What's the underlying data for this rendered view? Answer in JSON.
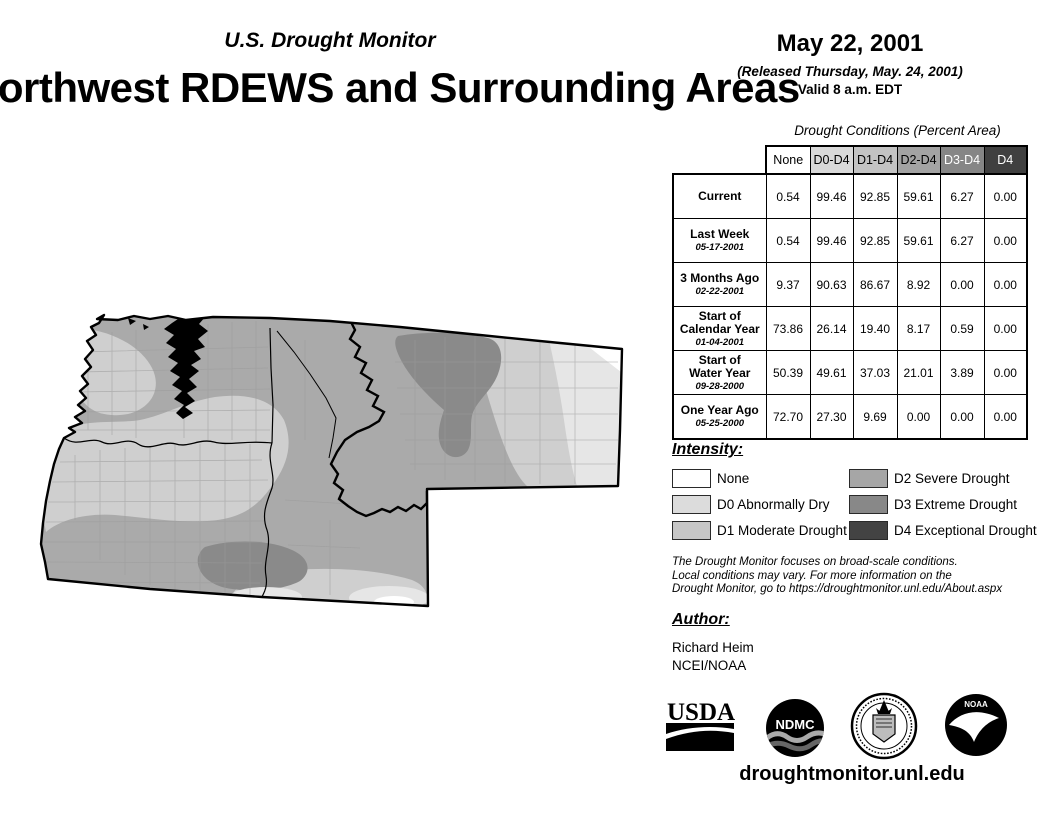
{
  "header": {
    "monitor_title": "U.S. Drought Monitor",
    "map_title": "Northwest RDEWS and Surrounding Areas",
    "date": "May 22, 2001",
    "released": "(Released Thursday, May. 24, 2001)",
    "valid": "Valid 8 a.m. EDT"
  },
  "table": {
    "title": "Drought Conditions (Percent Area)",
    "columns": [
      "None",
      "D0-D4",
      "D1-D4",
      "D2-D4",
      "D3-D4",
      "D4"
    ],
    "header_styles": [
      {
        "bg": "#ffffff",
        "fg": "#000000"
      },
      {
        "bg": "#d9d9d9",
        "fg": "#000000"
      },
      {
        "bg": "#c3c3c3",
        "fg": "#000000"
      },
      {
        "bg": "#a3a3a3",
        "fg": "#000000"
      },
      {
        "bg": "#868686",
        "fg": "#ffffff"
      },
      {
        "bg": "#404040",
        "fg": "#ffffff"
      }
    ],
    "rows": [
      {
        "label": "Current",
        "date": "",
        "values": [
          "0.54",
          "99.46",
          "92.85",
          "59.61",
          "6.27",
          "0.00"
        ]
      },
      {
        "label": "Last Week",
        "date": "05-17-2001",
        "values": [
          "0.54",
          "99.46",
          "92.85",
          "59.61",
          "6.27",
          "0.00"
        ]
      },
      {
        "label": "3 Months Ago",
        "date": "02-22-2001",
        "values": [
          "9.37",
          "90.63",
          "86.67",
          "8.92",
          "0.00",
          "0.00"
        ]
      },
      {
        "label": "Start of\nCalendar Year",
        "date": "01-04-2001",
        "values": [
          "73.86",
          "26.14",
          "19.40",
          "8.17",
          "0.59",
          "0.00"
        ]
      },
      {
        "label": "Start of\nWater Year",
        "date": "09-28-2000",
        "values": [
          "50.39",
          "49.61",
          "37.03",
          "21.01",
          "3.89",
          "0.00"
        ]
      },
      {
        "label": "One Year Ago",
        "date": "05-25-2000",
        "values": [
          "72.70",
          "27.30",
          "9.69",
          "0.00",
          "0.00",
          "0.00"
        ]
      }
    ]
  },
  "legend": {
    "title": "Intensity:",
    "items": [
      {
        "label": "None",
        "color": "#ffffff"
      },
      {
        "label": "D0 Abnormally Dry",
        "color": "#dcdcdc"
      },
      {
        "label": "D1 Moderate Drought",
        "color": "#c6c6c6"
      },
      {
        "label": "D2 Severe Drought",
        "color": "#a6a6a6"
      },
      {
        "label": "D3 Extreme Drought",
        "color": "#888888"
      },
      {
        "label": "D4 Exceptional Drought",
        "color": "#434343"
      }
    ]
  },
  "disclaimer": {
    "line1": "The Drought Monitor focuses on broad-scale conditions.",
    "line2": "Local conditions may vary. For more information on the",
    "line3": "Drought Monitor, go to https://droughtmonitor.unl.edu/About.aspx"
  },
  "author": {
    "title": "Author:",
    "name": "Richard Heim",
    "org": "NCEI/NOAA"
  },
  "logos": {
    "usda": "USDA",
    "ndmc": "NDMC",
    "doc": "department-of-commerce-seal",
    "noaa": "NOAA"
  },
  "footer": {
    "url": "droughtmonitor.unl.edu"
  },
  "map": {
    "palette": {
      "none": "#ffffff",
      "d0": "#e6e6e6",
      "d1": "#cfcfcf",
      "d2": "#aaaaaa",
      "d3": "#8a8a8a"
    }
  }
}
